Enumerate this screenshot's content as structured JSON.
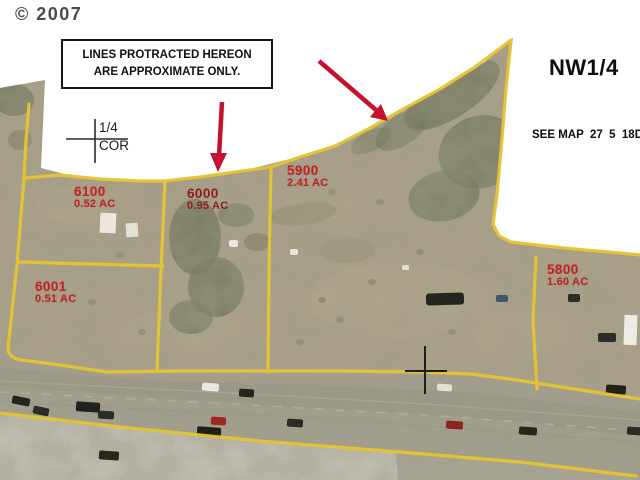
{
  "copyright": "© 2007",
  "disclaimer": {
    "line1": "LINES PROTRACTED HEREON",
    "line2": "ARE APPROXIMATE ONLY."
  },
  "quadrant_label": "NW1/4",
  "see_map_label": "SEE MAP  27  5  18D",
  "see_map_partial": "c",
  "quarter_corner": {
    "top": "1/4",
    "bottom": "COR"
  },
  "parcels": [
    {
      "id": "6100",
      "acreage": "0.52 AC"
    },
    {
      "id": "6000",
      "acreage": "0.95 AC"
    },
    {
      "id": "5900",
      "acreage": "2.41 AC"
    },
    {
      "id": "6001",
      "acreage": "0.51 AC"
    },
    {
      "id": "5800",
      "acreage": "1.60 AC"
    }
  ],
  "colors": {
    "boundary": "#e7c431",
    "parcel_label": "#c32222",
    "arrow": "#c41230",
    "background": "#ffffff"
  }
}
